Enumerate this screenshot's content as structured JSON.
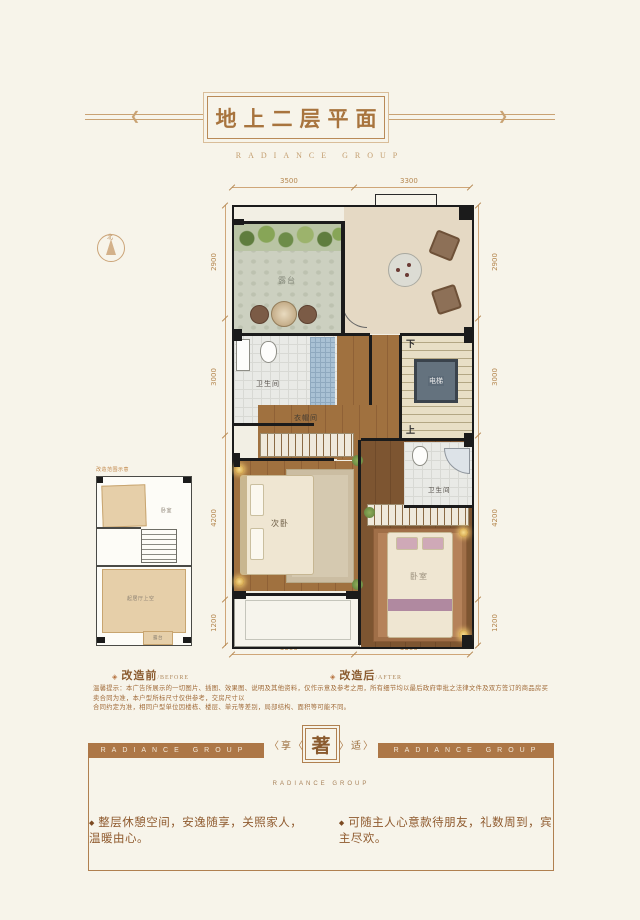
{
  "header": {
    "title": "地上二层平面",
    "subtitle": "RADIANCE GROUP",
    "deco_left": "❮",
    "deco_right": "❯"
  },
  "compass": {
    "north": "北"
  },
  "plan": {
    "dims": {
      "top": [
        "3500",
        "3300"
      ],
      "bottom": [
        "3500",
        "3300"
      ],
      "left": [
        "2900",
        "3000",
        "4200",
        "1200"
      ],
      "right": [
        "2900",
        "3000",
        "4200",
        "1200"
      ]
    },
    "rooms": {
      "terrace": "露台",
      "bath1": "卫生间",
      "closet": "衣帽间",
      "bedroom2": "次卧",
      "master": "卧室",
      "bath2": "卫生间",
      "elevator": "电梯",
      "stair_down": "下",
      "stair_up": "上"
    }
  },
  "before_plan": {
    "note": "改造范围示意",
    "rooms": {
      "bedroom": "卧室",
      "living_void": "起居厅上空",
      "balcony": "露台"
    }
  },
  "captions": {
    "marker": "◈",
    "before": "改造前",
    "before_en": "/BEFORE",
    "after": "改造后",
    "after_en": "/AFTER"
  },
  "disclaimer": {
    "line1": "温馨提示：本广告所展示的一切图片、插图、效果图、说明及其他资料，仅作示意及参考之用，所有细节均以最后政府审批之法律文件及双方签订的商品房买卖合同为准，本户型所标尺寸仅供参考，交房尺寸以",
    "line2": "合同约定为准，相同户型单位因楼栋、楼层、单元等差别，局部结构、面积等可能不同。"
  },
  "footer": {
    "band_left": "RADIANCE GROUP",
    "band_right": "RADIANCE GROUP",
    "chev_l": "〈",
    "chev_r": "〉",
    "emblem_left": "享",
    "emblem_center": "著",
    "emblem_right": "适",
    "emblem_sub": "RADIANCE GROUP",
    "marker": "◆",
    "bullet1": "整层休憩空间，安逸随享，关照家人，温暖由心。",
    "bullet2": "可随主人心意款待朋友，礼数周到，宾主尽欢。"
  }
}
